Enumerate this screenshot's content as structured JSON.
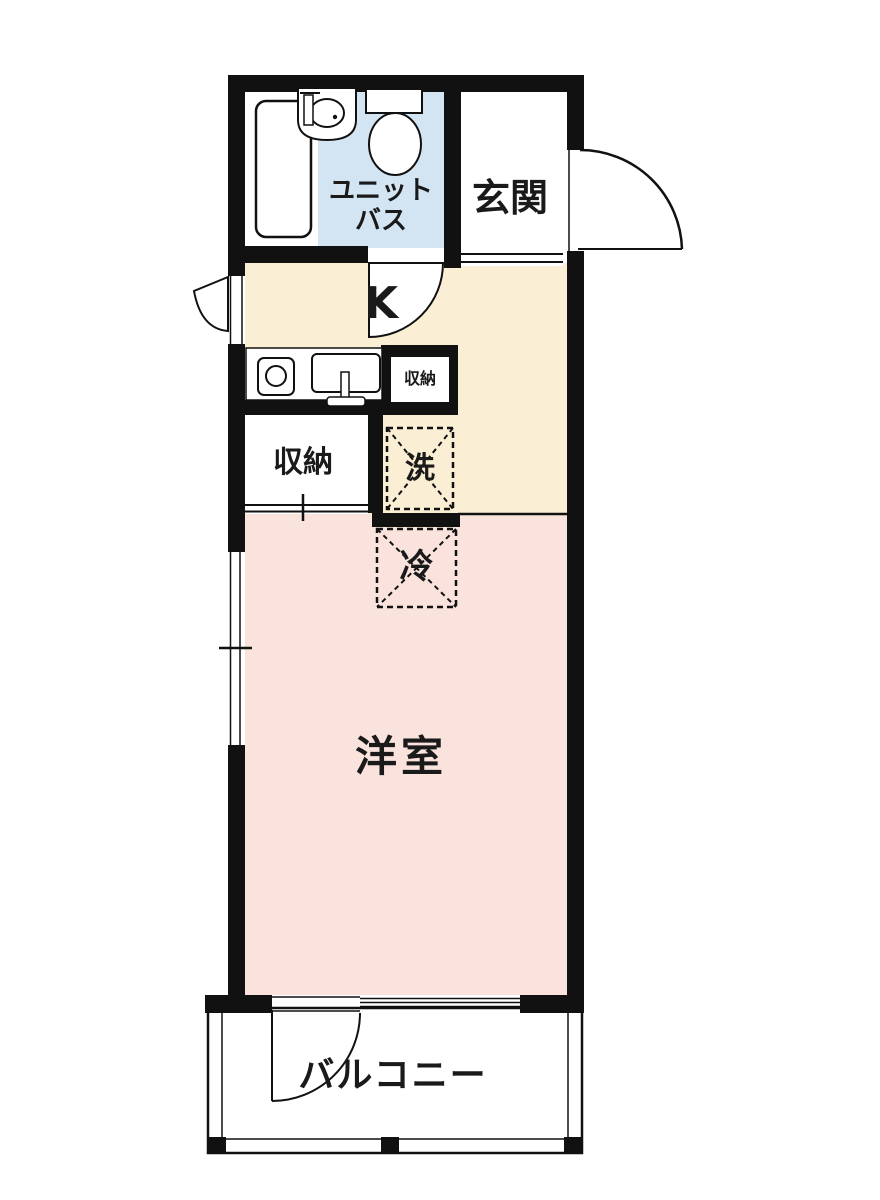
{
  "floorplan": {
    "title": "apartment-floor-plan",
    "rooms": {
      "unit_bath": {
        "label_line1": "ユニット",
        "label_line2": "バス"
      },
      "entrance": {
        "label": "玄関"
      },
      "kitchen": {
        "label": "K"
      },
      "kitchen_storage": {
        "label": "収納"
      },
      "storage": {
        "label": "収納"
      },
      "washer_space": {
        "label": "洗"
      },
      "fridge_space": {
        "label": "冷"
      },
      "western_room": {
        "label": "洋室"
      },
      "balcony": {
        "label": "バルコニー"
      }
    },
    "fixtures": [
      "bathtub-icon",
      "washbasin-icon",
      "toilet-icon",
      "stove-icon",
      "kitchen-sink-icon",
      "entrance-door-swing-icon",
      "bath-door-swing-icon",
      "balcony-door-swing-icon",
      "window-wedge-icon"
    ],
    "colors": {
      "wall": "#111111",
      "bath": "#d3e5f3",
      "kitchen": "#faefd5",
      "room": "#fae3dc",
      "white": "#ffffff"
    }
  }
}
